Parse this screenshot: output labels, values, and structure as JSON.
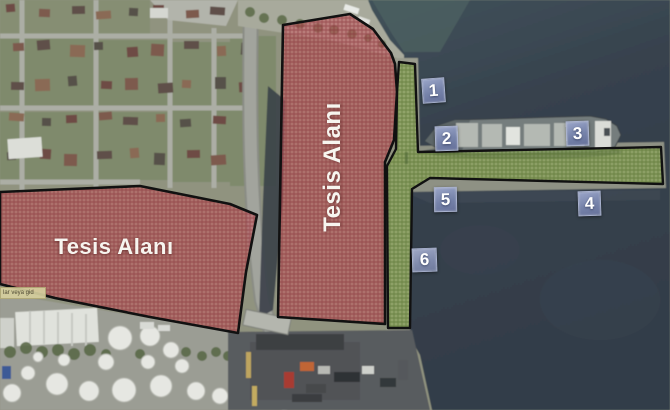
{
  "map": {
    "facility_areas": [
      {
        "id": "west",
        "label": "Tesis Alanı"
      },
      {
        "id": "center",
        "label": "Tesis Alanı"
      }
    ],
    "berth_markers": [
      {
        "num": "1"
      },
      {
        "num": "2"
      },
      {
        "num": "3"
      },
      {
        "num": "4"
      },
      {
        "num": "5"
      },
      {
        "num": "6"
      }
    ],
    "note_label": "lar veya gid",
    "colors": {
      "facility_overlay": "#c4565c",
      "facility_hatch": "#7e262e",
      "pier_overlay": "#8aa850",
      "pier_hatch": "#4e6a28",
      "marker_box": "#7683aa",
      "sea": "#37414d",
      "outline": "#111111"
    }
  }
}
